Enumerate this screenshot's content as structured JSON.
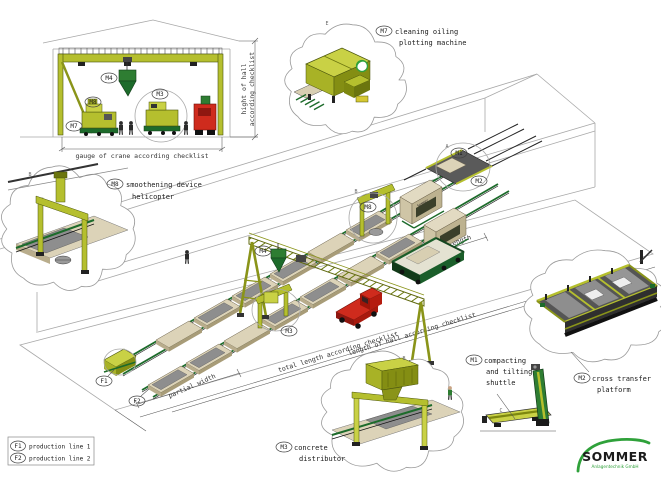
{
  "colors": {
    "olive_light": "#c9d145",
    "olive": "#b5bf2e",
    "olive_dark": "#848e13",
    "green": "#2e7d32",
    "green_dark": "#1d6b2b",
    "tan": "#dcd3b8",
    "tan_dark": "#b9ad8c",
    "slab_gray": "#8e8e8e",
    "red": "#cf2b1d",
    "wire_gray": "#a8a8a8",
    "logo_green": "#2fa13a"
  },
  "elevation": {
    "machine_labels": {
      "m4": "M4",
      "m8": "M8",
      "m3": "M3",
      "m7": "M7"
    },
    "dim_height_line1": "hight of hall",
    "dim_height_line2": "according checklist",
    "dim_gauge": "gauge of crane according checklist"
  },
  "main_view": {
    "labels": {
      "m4": "M4",
      "m8": "M8",
      "m3": "M3",
      "m1": "M1",
      "m2": "M2",
      "f1": "F1",
      "f2": "F2"
    },
    "refs": {
      "main_m8": "B",
      "main_end": "A"
    },
    "branding": "Sommer",
    "dims": {
      "partial_length": "partial length",
      "partial_width": "partial width",
      "total_length": "total length according checklist",
      "length_of_hall": "length of hall according checklist"
    }
  },
  "callouts": {
    "m7": {
      "code": "M7",
      "line1": "cleaning oiling",
      "line2": "plotting machine",
      "ref": "E"
    },
    "m8": {
      "code": "M8",
      "line1": "smoothening device",
      "line2": "helicopter",
      "ref": "B"
    },
    "m3": {
      "code": "M3",
      "line1": "concrete",
      "line2": "distributor",
      "ref": "B"
    },
    "m1": {
      "code": "M1",
      "line1": "compacting",
      "line2": "and tilting",
      "line3": "shuttle",
      "ref": "C"
    },
    "m2": {
      "code": "M2",
      "line1": "cross transfer",
      "line2": "platform"
    }
  },
  "legend": {
    "rows": [
      {
        "code": "F1",
        "label": "production line 1"
      },
      {
        "code": "F2",
        "label": "production line 2"
      }
    ]
  },
  "logo": {
    "name": "SOMMER",
    "tagline": "Anlagentechnik GmbH"
  }
}
